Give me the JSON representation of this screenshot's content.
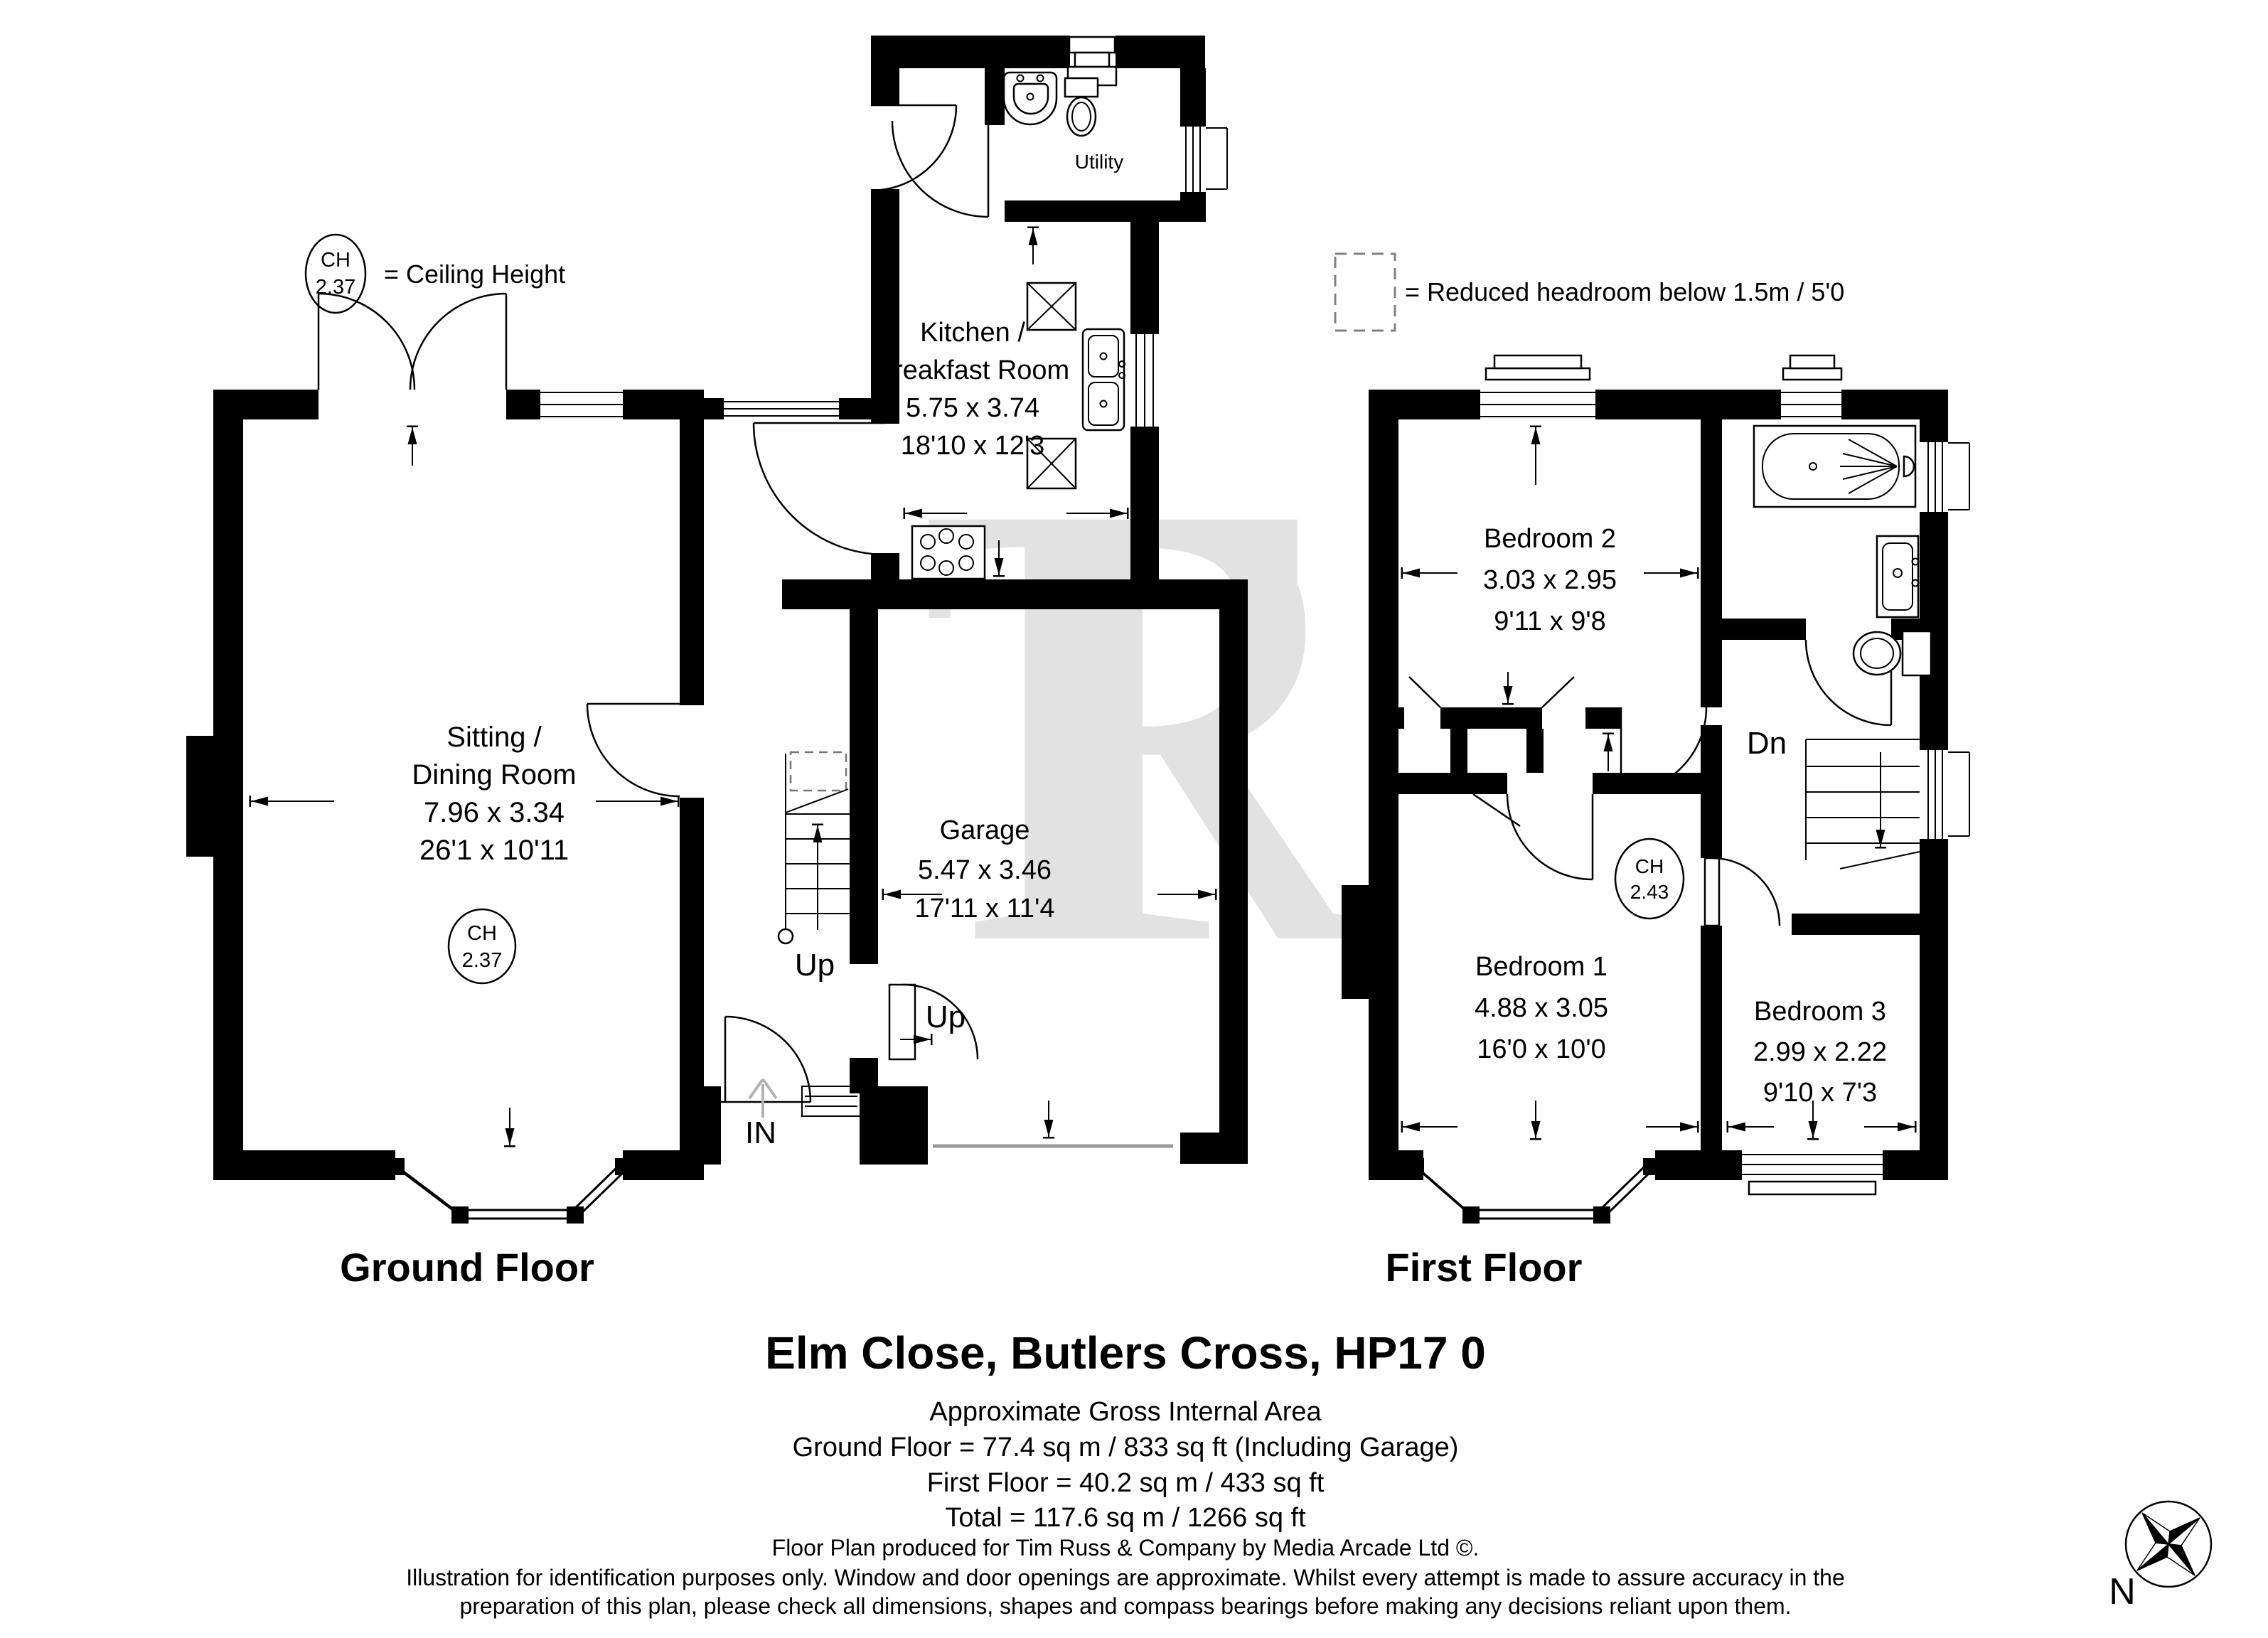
{
  "watermark": "TR",
  "legend": {
    "ch_abbr": "CH",
    "ch_value": "2.37",
    "ch_caption": "= Ceiling Height",
    "reduced_caption": "= Reduced headroom below 1.5m / 5'0"
  },
  "ground_floor": {
    "label": "Ground Floor",
    "utility": {
      "name": "Utility"
    },
    "kitchen": {
      "line1": "Kitchen /",
      "line2": "Breakfast Room",
      "metric": "5.75 x 3.74",
      "imperial": "18'10 x 12'3"
    },
    "sitting": {
      "line1": "Sitting /",
      "line2": "Dining Room",
      "metric": "7.96 x 3.34",
      "imperial": "26'1 x 10'11",
      "ch_abbr": "CH",
      "ch_value": "2.37"
    },
    "garage": {
      "name": "Garage",
      "metric": "5.47 x 3.46",
      "imperial": "17'11 x 11'4"
    },
    "stairs_up": "Up",
    "garage_up": "Up",
    "entrance": "IN"
  },
  "first_floor": {
    "label": "First Floor",
    "bedroom2": {
      "name": "Bedroom 2",
      "metric": "3.03 x 2.95",
      "imperial": "9'11 x 9'8"
    },
    "bedroom1": {
      "name": "Bedroom 1",
      "metric": "4.88 x 3.05",
      "imperial": "16'0 x 10'0"
    },
    "bedroom3": {
      "name": "Bedroom 3",
      "metric": "2.99 x 2.22",
      "imperial": "9'10 x 7'3"
    },
    "stairs_down": "Dn",
    "ch_abbr": "CH",
    "ch_value": "2.43"
  },
  "title": "Elm Close, Butlers Cross, HP17 0",
  "area_summary": {
    "heading": "Approximate Gross Internal Area",
    "ground": "Ground Floor = 77.4 sq m / 833 sq ft (Including Garage)",
    "first": "First Floor = 40.2 sq m / 433 sq ft",
    "total": "Total = 117.6 sq m / 1266 sq ft"
  },
  "footer": {
    "credit": "Floor Plan produced for Tim Russ & Company by Media Arcade Ltd ©.",
    "disclaimer_line1": "Illustration for identification purposes only. Window and door openings are approximate. Whilst every attempt is made to assure accuracy in the",
    "disclaimer_line2": "preparation of this plan, please check all dimensions, shapes and compass bearings before making any decisions reliant upon them."
  },
  "compass": {
    "north": "N"
  }
}
